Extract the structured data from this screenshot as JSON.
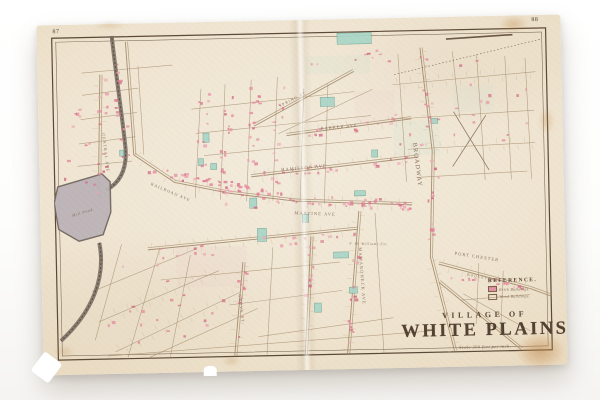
{
  "photo": {
    "backdrop_color": "#ffffff"
  },
  "sheet": {
    "paper_color": "#efe3cd",
    "plate_numbers": {
      "left": "87",
      "right": "88"
    },
    "title": {
      "line1": "VILLAGE OF",
      "line2": "WHITE PLAINS",
      "scale_note": "Scale 300 feet per inch."
    },
    "legend": {
      "heading": "REFERENCE.",
      "items": [
        {
          "label": "Brick Buildings.",
          "swatch_color": "#e193a6",
          "swatch_style": "filled"
        },
        {
          "label": "Wood Buildings.",
          "swatch_color": "#efe3cd",
          "swatch_style": "outline"
        }
      ]
    },
    "streets": [
      {
        "name": "BROADWAY",
        "x": 357,
        "y": 112,
        "rotate": 84,
        "size": 6.2
      },
      {
        "name": "MAMARONECK AVE",
        "x": 301,
        "y": 214,
        "rotate": 87,
        "size": 4.4
      },
      {
        "name": "PORT CHESTER",
        "x": 396,
        "y": 223,
        "rotate": 10,
        "size": 4.4
      },
      {
        "name": "HAMILTON AVE",
        "x": 226,
        "y": 137,
        "rotate": -4,
        "size": 4.4
      },
      {
        "name": "BARKER AVE",
        "x": 266,
        "y": 97,
        "rotate": -4,
        "size": 4.2
      },
      {
        "name": "MARTINE AVE",
        "x": 238,
        "y": 180,
        "rotate": 3,
        "size": 4.4
      },
      {
        "name": "RAILROAD AVE",
        "x": 96,
        "y": 148,
        "rotate": 24,
        "size": 4.0
      },
      {
        "name": "CENTRAL AVE",
        "x": 49,
        "y": 96,
        "rotate": 84,
        "size": 4.0
      },
      {
        "name": "GROVE ST",
        "x": 181,
        "y": 258,
        "rotate": 85,
        "size": 4.0
      },
      {
        "name": "SPRING ST",
        "x": 226,
        "y": 74,
        "rotate": -26,
        "size": 4.0
      },
      {
        "name": "BOULEVARD",
        "x": 408,
        "y": 244,
        "rotate": 12,
        "size": 3.6
      }
    ],
    "places": [
      {
        "name": "Mill Pond",
        "x": 18,
        "y": 178,
        "rotate": -16,
        "size": 4.0
      },
      {
        "name": "F. M. Williams Est.",
        "x": 292,
        "y": 211,
        "rotate": 2,
        "size": 3.6
      }
    ],
    "colors": {
      "border": "#5c4a38",
      "street": "#a48c6d",
      "lot_line": "#c6b193",
      "building_pink": "#e0809a",
      "building_teal": "#a8d6c8",
      "pond": "#bcb4b8",
      "rail": "#756a60",
      "label": "#7a6250",
      "title": "#463426"
    }
  }
}
